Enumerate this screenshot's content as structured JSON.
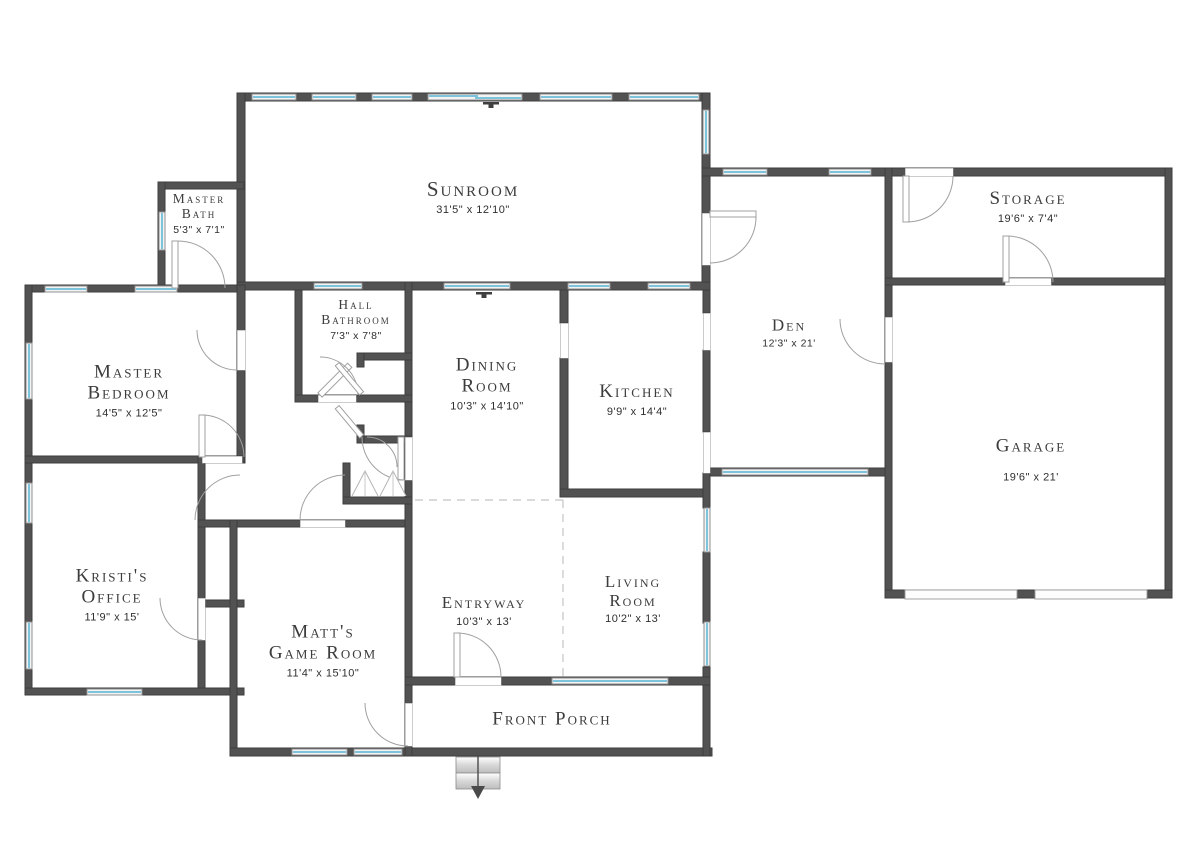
{
  "plan_type": "residential-floor-plan",
  "colors": {
    "wall": "#525252",
    "window_glass": "#7ec3dc",
    "door_arc": "#a0a0a0",
    "dashed_boundary": "#c4c4c4",
    "label_text": "#3c3c3c",
    "background": "#ffffff"
  },
  "rooms": {
    "sunroom": {
      "lines": [
        "Sunroom"
      ],
      "dims": "31'5\" x 12'10\""
    },
    "master_bath": {
      "lines": [
        "Master",
        "Bath"
      ],
      "dims": "5'3\" x 7'1\""
    },
    "hall_bathroom": {
      "lines": [
        "Hall",
        "Bathroom"
      ],
      "dims": "7'3\" x 7'8\""
    },
    "master_bedroom": {
      "lines": [
        "Master",
        "Bedroom"
      ],
      "dims": "14'5\" x 12'5\""
    },
    "dining_room": {
      "lines": [
        "Dining",
        "Room"
      ],
      "dims": "10'3\" x 14'10\""
    },
    "kitchen": {
      "lines": [
        "Kitchen"
      ],
      "dims": "9'9\" x 14'4\""
    },
    "den": {
      "lines": [
        "Den"
      ],
      "dims": "12'3\" x 21'"
    },
    "storage": {
      "lines": [
        "Storage"
      ],
      "dims": "19'6\" x 7'4\""
    },
    "garage": {
      "lines": [
        "Garage"
      ],
      "dims": "19'6\" x 21'"
    },
    "kristis_office": {
      "lines": [
        "Kristi's",
        "Office"
      ],
      "dims": "11'9\" x 15'"
    },
    "matts_game_room": {
      "lines": [
        "Matt's",
        "Game Room"
      ],
      "dims": "11'4\" x 15'10\""
    },
    "entryway": {
      "lines": [
        "Entryway"
      ],
      "dims": "10'3\" x 13'"
    },
    "living_room": {
      "lines": [
        "Living",
        "Room"
      ],
      "dims": "10'2\" x 13'"
    },
    "front_porch": {
      "lines": [
        "Front Porch"
      ],
      "dims": ""
    }
  }
}
